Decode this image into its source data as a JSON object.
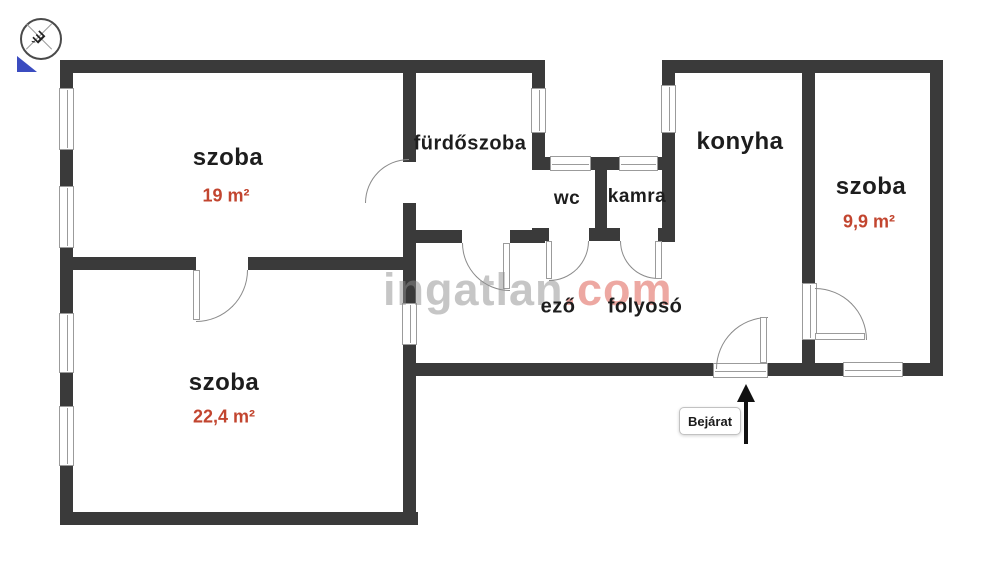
{
  "colors": {
    "wall": "#3a3a3a",
    "accent": "#c2452f",
    "line": "#8a8a8a",
    "wm_gray": "#8f8f8f",
    "wm_red": "#dd5347",
    "blue": "#3b4cc0"
  },
  "compass": {
    "letter": "É"
  },
  "watermark": {
    "gray_part": "ingatlan",
    "red_part": ".com"
  },
  "rooms": {
    "room_top_left": {
      "name": "szoba",
      "area": "19 m²"
    },
    "room_bottom_left": {
      "name": "szoba",
      "area": "22,4 m²"
    },
    "room_right": {
      "name": "szoba",
      "area": "9,9 m²"
    },
    "bathroom": {
      "name": "fürdőszoba"
    },
    "wc": {
      "name": "wc"
    },
    "pantry": {
      "name": "kamra"
    },
    "kitchen": {
      "name": "konyha"
    },
    "dining_partial": {
      "name": "ező"
    },
    "hallway": {
      "name": "folyosó"
    }
  },
  "entrance": {
    "label": "Bejárat"
  }
}
